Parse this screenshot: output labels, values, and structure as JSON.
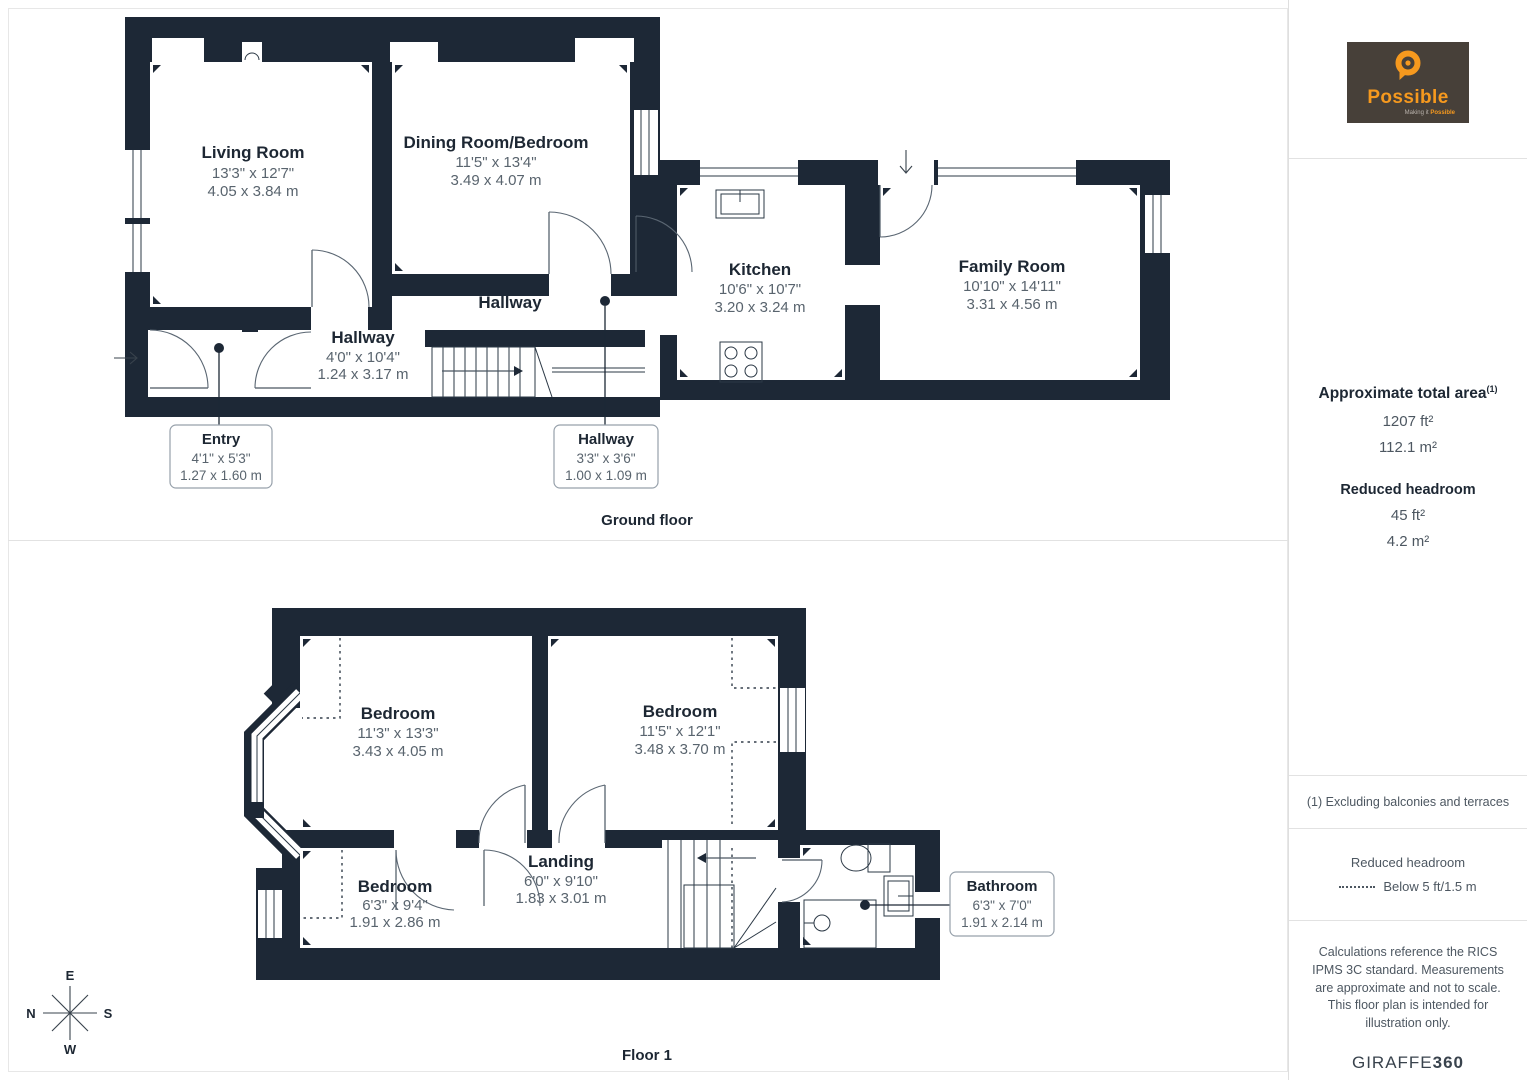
{
  "page": {
    "wall_color": "#1d2836",
    "background": "#ffffff"
  },
  "brand": {
    "logo_text": "Possible",
    "tagline_prefix": "Making it ",
    "tagline_suffix": "Possible",
    "logo_bg": "#474039",
    "accent": "#f6991e"
  },
  "sidebar": {
    "area_title": "Approximate total area",
    "area_footnote_marker": "(1)",
    "area_ft": "1207 ft²",
    "area_m": "112.1 m²",
    "reduced_title": "Reduced headroom",
    "reduced_ft": "45 ft²",
    "reduced_m": "4.2 m²",
    "footnote": "(1) Excluding balconies and terraces",
    "legend_title": "Reduced headroom",
    "legend_label": "Below 5 ft/1.5 m",
    "disclaimer": "Calculations reference the RICS IPMS 3C standard. Measurements are approximate and not to scale. This floor plan is intended for illustration only.",
    "credit_prefix": "GIRAFFE",
    "credit_suffix": "360"
  },
  "ground_floor": {
    "title": "Ground floor",
    "rooms": [
      {
        "name": "Living Room",
        "imperial": "13'3\" x 12'7\"",
        "metric": "4.05 x 3.84 m"
      },
      {
        "name": "Dining Room/Bedroom",
        "imperial": "11'5\" x 13'4\"",
        "metric": "3.49 x 4.07 m"
      },
      {
        "name": "Kitchen",
        "imperial": "10'6\" x 10'7\"",
        "metric": "3.20 x 3.24 m"
      },
      {
        "name": "Family Room",
        "imperial": "10'10\" x 14'11\"",
        "metric": "3.31 x 4.56 m"
      },
      {
        "name": "Hallway",
        "imperial": "4'0\" x 10'4\"",
        "metric": "1.24 x 3.17 m"
      },
      {
        "name": "Hallway"
      }
    ],
    "callouts": [
      {
        "name": "Entry",
        "imperial": "4'1\" x 5'3\"",
        "metric": "1.27 x 1.60 m"
      },
      {
        "name": "Hallway",
        "imperial": "3'3\" x 3'6\"",
        "metric": "1.00 x 1.09 m"
      }
    ]
  },
  "floor_1": {
    "title": "Floor 1",
    "rooms": [
      {
        "name": "Bedroom",
        "imperial": "11'3\" x 13'3\"",
        "metric": "3.43 x 4.05 m"
      },
      {
        "name": "Bedroom",
        "imperial": "11'5\" x 12'1\"",
        "metric": "3.48 x 3.70 m"
      },
      {
        "name": "Bedroom",
        "imperial": "6'3\" x 9'4\"",
        "metric": "1.91 x 2.86 m"
      },
      {
        "name": "Landing",
        "imperial": "6'0\" x 9'10\"",
        "metric": "1.83 x 3.01 m"
      }
    ],
    "callouts": [
      {
        "name": "Bathroom",
        "imperial": "6'3\" x 7'0\"",
        "metric": "1.91 x 2.14 m"
      }
    ]
  },
  "compass": {
    "top": "E",
    "left": "N",
    "right": "S",
    "bottom": "W"
  }
}
